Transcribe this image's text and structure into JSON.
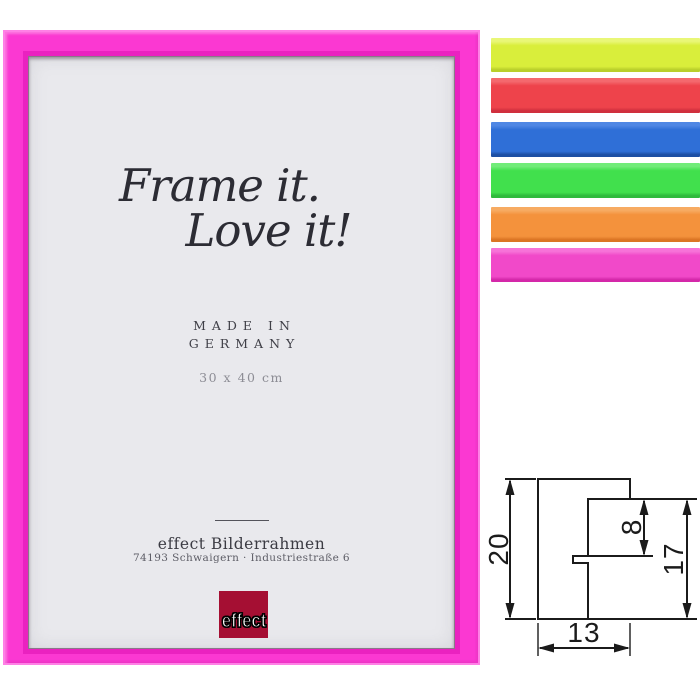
{
  "product_frame": {
    "title_line1": "Frame it.",
    "title_line2": "Love it!",
    "made_in_line1": "MADE IN",
    "made_in_line2": "GERMANY",
    "size_label": "30 x 40 cm",
    "brand_name": "effect Bilderrahmen",
    "brand_address": "74193 Schwaigern · Industriestraße 6",
    "logo_text": "effect",
    "colors": {
      "frame": "#fb38d2",
      "frame_highlight": "#ff80e6",
      "frame_bevel": "#ea22c0",
      "mat": "#e9e9ed",
      "logo_bg": "#a50f33"
    }
  },
  "color_swatches": {
    "items": [
      {
        "name": "neon-yellow",
        "color": "#d9ee3b",
        "highlight": "#e9f777",
        "shadow": "#b9cf2b"
      },
      {
        "name": "neon-red",
        "color": "#ee434b",
        "highlight": "#f4696e",
        "shadow": "#d02f3d"
      },
      {
        "name": "blue",
        "color": "#2f6fd7",
        "highlight": "#4f87e4",
        "shadow": "#1d4fa4"
      },
      {
        "name": "neon-green",
        "color": "#41e04d",
        "highlight": "#71ec79",
        "shadow": "#2eba3c"
      },
      {
        "name": "neon-orange",
        "color": "#f4923c",
        "highlight": "#f7ab62",
        "shadow": "#db7524"
      },
      {
        "name": "neon-pink",
        "color": "#f149c9",
        "highlight": "#f773d8",
        "shadow": "#d428a9"
      }
    ]
  },
  "technical_drawing": {
    "dim_overall_height": "20",
    "dim_rabbet_depth": "8",
    "dim_inner_height": "17",
    "dim_width": "13"
  }
}
